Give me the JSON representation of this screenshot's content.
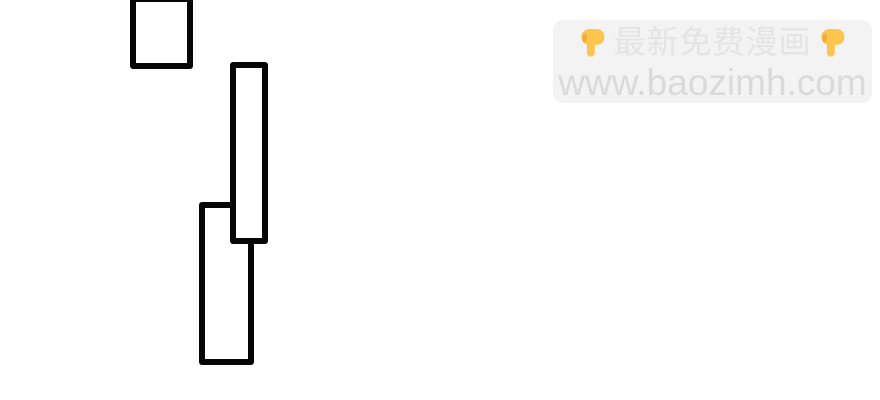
{
  "page": {
    "type": "comic-page-scan",
    "background": "#ffffff"
  },
  "watermark": {
    "line1_text": "最新免费漫画",
    "line2_text": "www.baozimh.com",
    "left_icon": "backhand-index-pointing-down-emoji",
    "right_icon": "backhand-index-pointing-down-emoji"
  },
  "colors": {
    "page_bg": "#ffffff",
    "panel_stroke": "#060606",
    "panel_fill": "#ffffff",
    "wm_box_bg": "#f3f3f3",
    "wm_line1_text": "#e4e4e4",
    "wm_line2_text": "#dadada",
    "emoji_yellow": "#fcc54d",
    "emoji_shade": "#f0ad3c"
  },
  "panels": {
    "stroke_width": 6,
    "rects": [
      {
        "left": 130,
        "top": -4,
        "width": 63,
        "height": 73
      },
      {
        "left": 230,
        "top": 62,
        "width": 38,
        "height": 182
      },
      {
        "left": 199,
        "top": 202,
        "width": 55,
        "height": 163
      }
    ]
  }
}
